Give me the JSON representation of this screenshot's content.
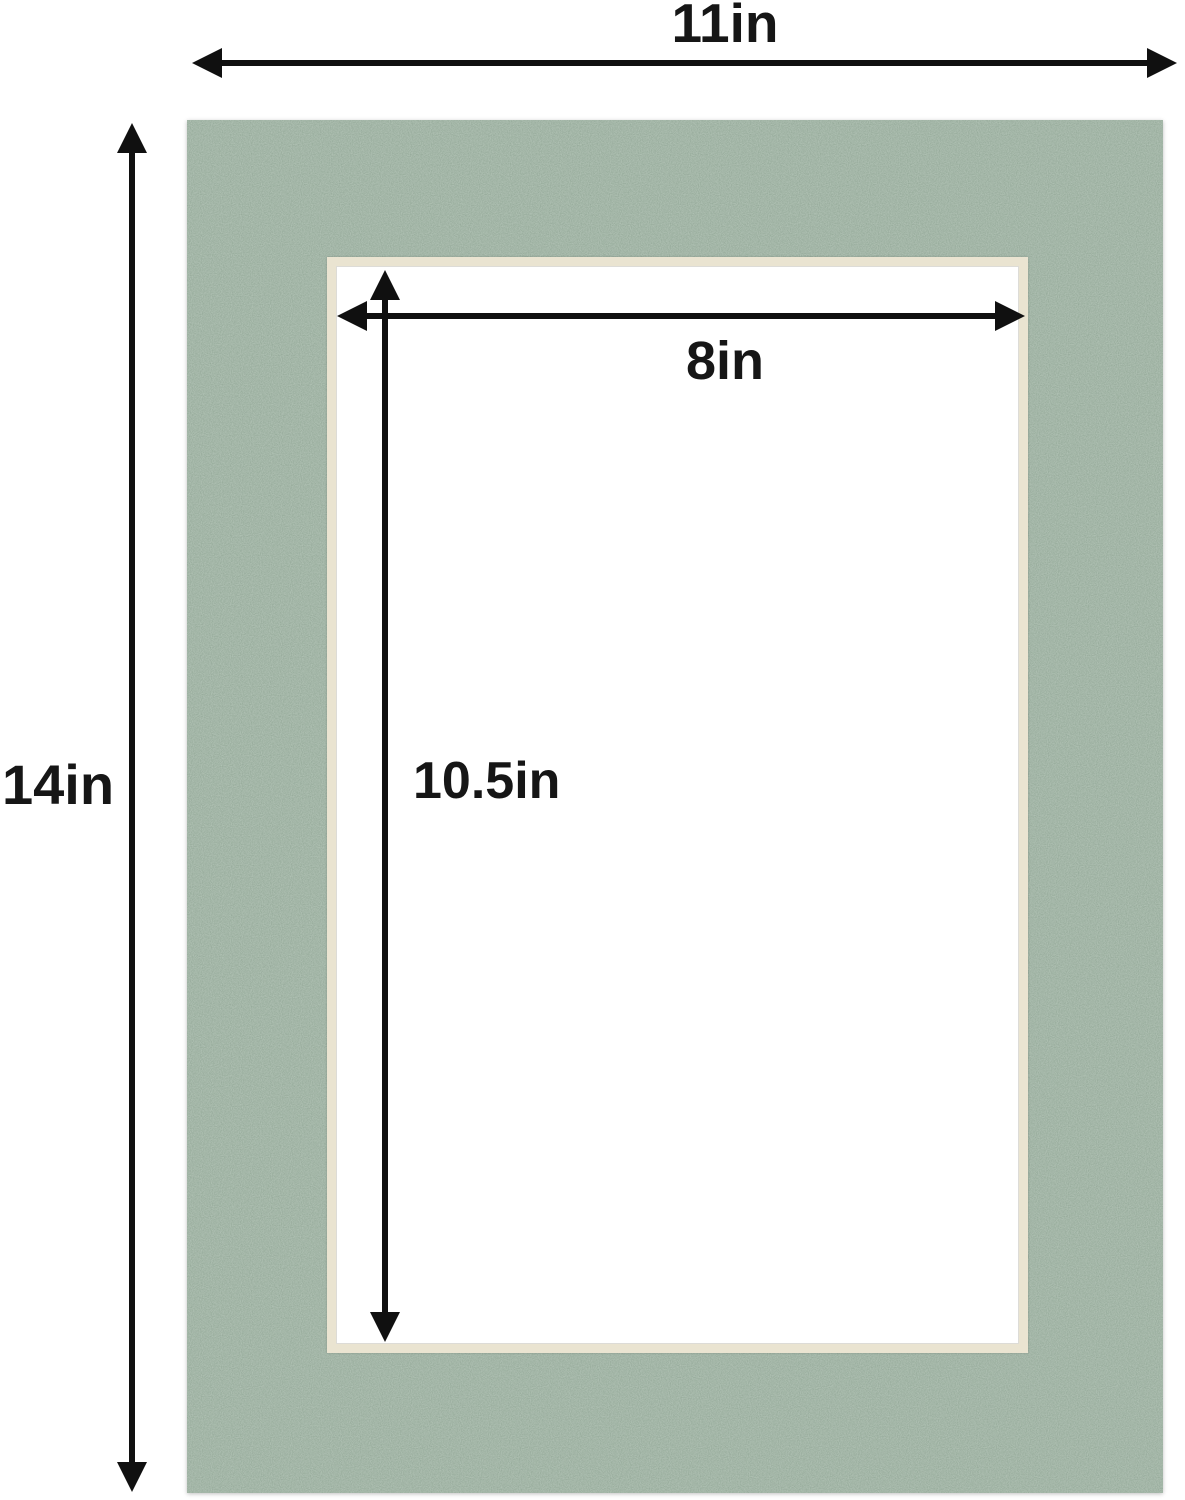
{
  "diagram": {
    "subject": "picture-frame-mat-with-dimension-arrows",
    "dimensions": {
      "outer_width": {
        "label": "11in"
      },
      "outer_height": {
        "label": "14in"
      },
      "opening_width": {
        "label": "8in"
      },
      "opening_height": {
        "label": "10.5in"
      }
    },
    "colors": {
      "mat_green": "#5b7260",
      "bevel_cream": "#eae4d1",
      "opening_white": "#ffffff",
      "arrow_black": "#101010",
      "text_black": "#161616",
      "background": "#ffffff"
    }
  }
}
